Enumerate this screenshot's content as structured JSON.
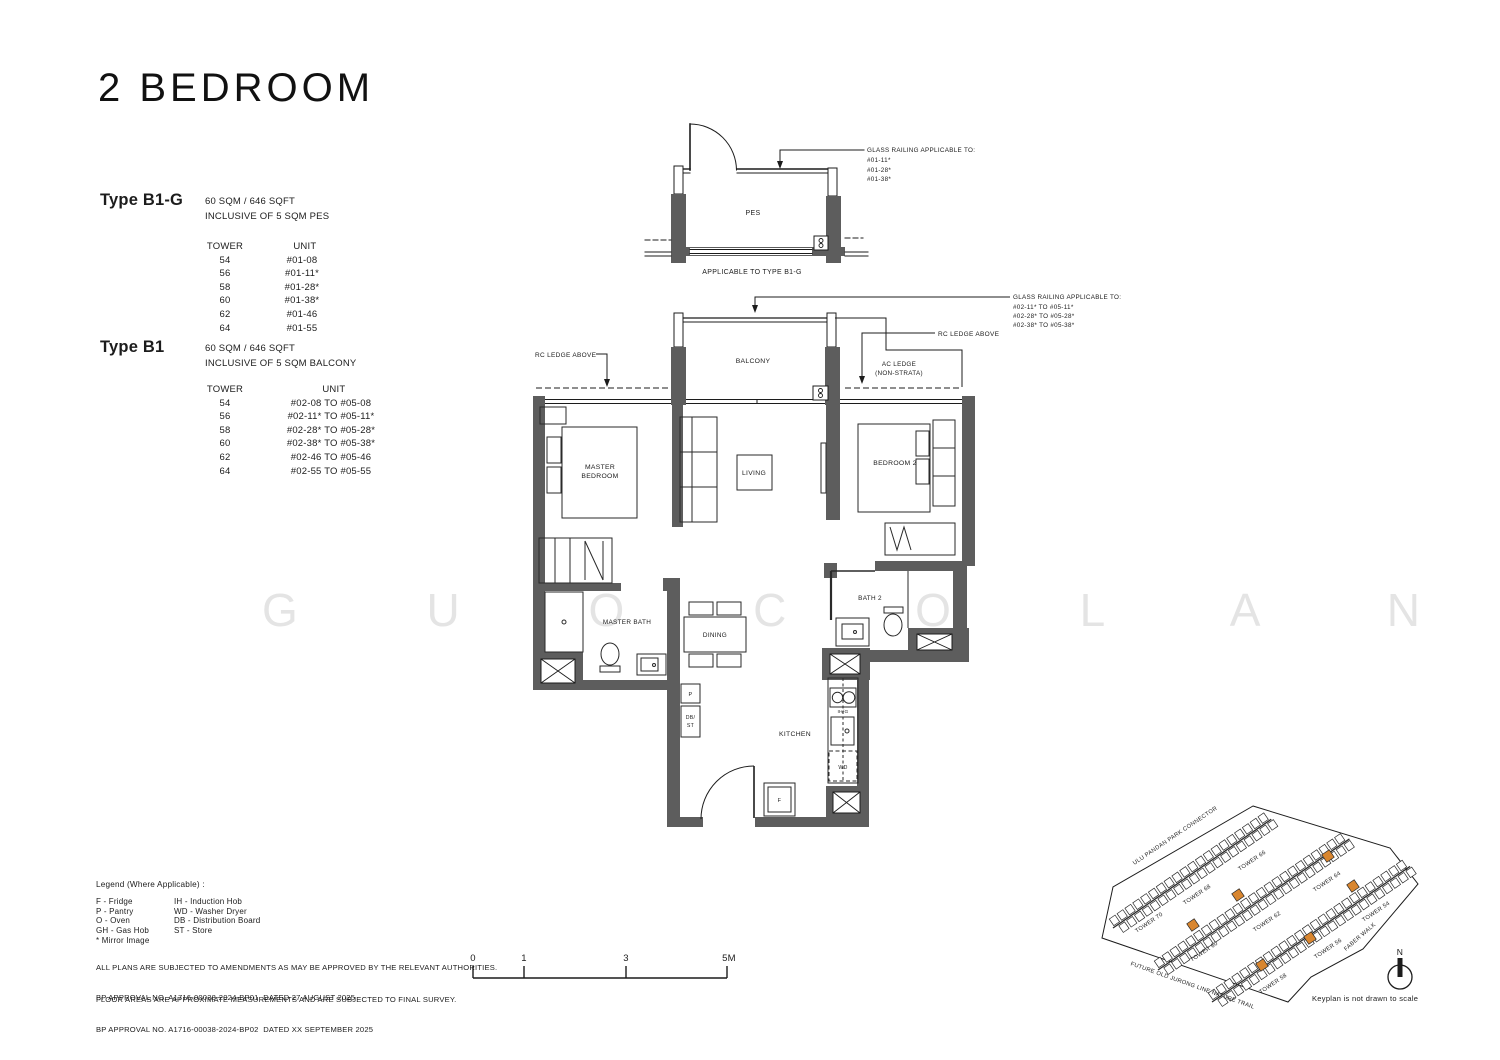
{
  "page": {
    "title": "2 BEDROOM",
    "watermark": "G U O C O L A N D _"
  },
  "types": [
    {
      "name": "Type B1-G",
      "area": "60 SQM / 646 SQFT",
      "inclusive": "INCLUSIVE OF 5 SQM PES",
      "headers": {
        "tower": "TOWER",
        "unit": "UNIT"
      },
      "rows": [
        {
          "tower": "54",
          "unit": "#01-08"
        },
        {
          "tower": "56",
          "unit": "#01-11*"
        },
        {
          "tower": "58",
          "unit": "#01-28*"
        },
        {
          "tower": "60",
          "unit": "#01-38*"
        },
        {
          "tower": "62",
          "unit": "#01-46"
        },
        {
          "tower": "64",
          "unit": "#01-55"
        }
      ]
    },
    {
      "name": "Type B1",
      "area": "60 SQM / 646 SQFT",
      "inclusive": "INCLUSIVE OF 5 SQM BALCONY",
      "headers": {
        "tower": "TOWER",
        "unit": "UNIT"
      },
      "rows": [
        {
          "tower": "54",
          "unit": "#02-08 TO #05-08"
        },
        {
          "tower": "56",
          "unit": "#02-11* TO #05-11*"
        },
        {
          "tower": "58",
          "unit": "#02-28* TO #05-28*"
        },
        {
          "tower": "60",
          "unit": "#02-38* TO #05-38*"
        },
        {
          "tower": "62",
          "unit": "#02-46 TO #05-46"
        },
        {
          "tower": "64",
          "unit": "#02-55 TO #05-55"
        }
      ]
    }
  ],
  "plan": {
    "rooms": {
      "pes": "PES",
      "balcony": "BALCONY",
      "living": "LIVING",
      "dining": "DINING",
      "kitchen": "KITCHEN",
      "bedroom2": "BEDROOM 2",
      "bath2": "BATH 2",
      "master_bath": "MASTER BATH",
      "master_bedroom_1": "MASTER",
      "master_bedroom_2": "BEDROOM"
    },
    "fixtures": {
      "p": "P",
      "db": "DB/",
      "st": "ST",
      "ihg": "IH/G",
      "wd": "WD",
      "f": "F"
    },
    "annotations": {
      "applicable": "APPLICABLE TO TYPE B1-G",
      "rc_ledge": "RC LEDGE ABOVE",
      "ac_ledge_1": "AC LEDGE",
      "ac_ledge_2": "(NON-STRATA)",
      "pes_railing": {
        "title": "GLASS RAILING APPLICABLE TO:",
        "lines": [
          "#01-11*",
          "#01-28*",
          "#01-38*"
        ]
      },
      "upper_railing": {
        "title": "GLASS RAILING APPLICABLE TO:",
        "lines": [
          "#02-11* TO #05-11*",
          "#02-28* TO #05-28*",
          "#02-38* TO #05-38*"
        ]
      }
    }
  },
  "legend": {
    "title": "Legend (Where Applicable) :",
    "col1": [
      "F - Fridge",
      "P - Pantry",
      "O - Oven",
      "GH - Gas Hob",
      "* Mirror Image"
    ],
    "col2": [
      "IH - Induction Hob",
      "WD - Washer Dryer",
      "DB - Distribution Board",
      "ST - Store"
    ]
  },
  "notes": [
    "ALL PLANS ARE SUBJECTED TO AMENDMENTS AS MAY BE APPROVED BY THE RELEVANT AUTHORITIES.",
    "FLOOR AREAS ARE APPROXIMATE MEASUREMENTS AND ARE SUBJECTED TO FINAL SURVEY."
  ],
  "approvals": [
    "BP APPROVAL NO. A1716-00038-2024-BP01  DATED 27 AUGUST 2025",
    "BP APPROVAL NO. A1716-00038-2024-BP02  DATED XX SEPTEMBER 2025"
  ],
  "scalebar": {
    "labels": [
      "0",
      "1",
      "3",
      "5M"
    ]
  },
  "keyplan": {
    "streets": {
      "connector": "ULU PANDAN PARK CONNECTOR",
      "trail": "FUTURE OLD JURONG LINE NATURE TRAIL",
      "faber": "FABER WALK"
    },
    "towers": [
      {
        "label": "TOWER 70"
      },
      {
        "label": "TOWER 68"
      },
      {
        "label": "TOWER 66"
      },
      {
        "label": "TOWER 60"
      },
      {
        "label": "TOWER 62"
      },
      {
        "label": "TOWER 64"
      },
      {
        "label": "TOWER 58"
      },
      {
        "label": "TOWER 56"
      },
      {
        "label": "TOWER 54"
      }
    ],
    "north": "N",
    "note": "Keyplan is not drawn to scale"
  },
  "colors": {
    "wall": "#5d5d5d",
    "line": "#1c1c1c",
    "highlight": "#D9862F",
    "watermark": "#E4E4E4"
  }
}
